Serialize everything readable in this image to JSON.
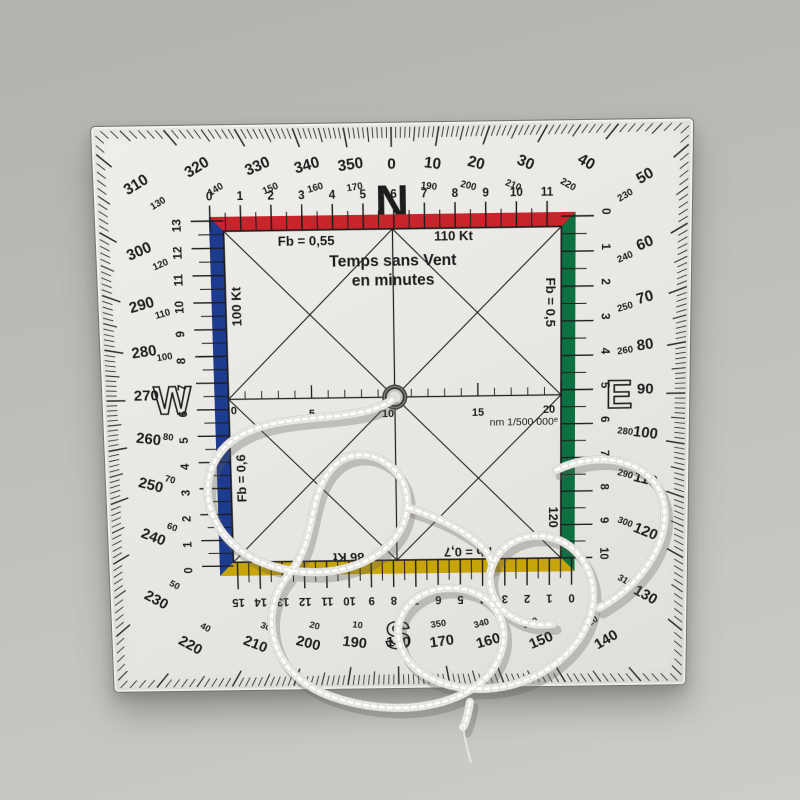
{
  "scene": {
    "description": "square transparent navigation plotter (protractor) lying on grey surface with white cord tangled on top"
  },
  "plotter": {
    "cardinals": {
      "north": "N",
      "east": "E",
      "south": "S",
      "west": "W"
    },
    "rose": {
      "ring_big_labels": {
        "top": [
          "320",
          "330",
          "340",
          "350",
          "0",
          "10",
          "20",
          "30",
          "40"
        ],
        "right": [
          "50",
          "60",
          "70",
          "80",
          "90",
          "100",
          "110",
          "120",
          "130"
        ],
        "bottom": [
          "140",
          "150",
          "160",
          "170",
          "180",
          "190",
          "200",
          "210",
          "220"
        ],
        "left": [
          "230",
          "240",
          "250",
          "260",
          "270",
          "280",
          "290",
          "300",
          "310"
        ]
      },
      "ring_small_labels": {
        "top": [
          "140",
          "150",
          "160",
          "170",
          "",
          "190",
          "200",
          "210",
          "220"
        ],
        "right": [
          "230",
          "240",
          "250",
          "260",
          "",
          "280",
          "290",
          "300",
          "310"
        ],
        "bottom": [
          "320",
          "330",
          "340",
          "350",
          "",
          "10",
          "20",
          "30",
          "40"
        ],
        "left": [
          "50",
          "60",
          "70",
          "80",
          "",
          "100",
          "110",
          "120",
          "130"
        ]
      }
    },
    "inner": {
      "title": [
        "Temps sans Vent",
        "en minutes"
      ],
      "labels": {
        "top_left": "Fb = 0,55",
        "top_right": "110 Kt",
        "left_top": "100 Kt",
        "left_bottom": "Fb = 0,6",
        "right_top": "Fb = 0,5",
        "right_bottom": "120",
        "bottom_left": "86 Kt",
        "bottom_right": "Fb = 0,7"
      },
      "scales": {
        "top": [
          "0",
          "1",
          "2",
          "3",
          "4",
          "5",
          "6",
          "7",
          "8",
          "9",
          "10",
          "11"
        ],
        "left": [
          "13",
          "12",
          "11",
          "10",
          "9",
          "8",
          "7",
          "6",
          "5",
          "4",
          "3",
          "2",
          "1",
          "0"
        ],
        "right": [
          "0",
          "1",
          "2",
          "3",
          "4",
          "5",
          "6",
          "7",
          "8",
          "9",
          "10"
        ],
        "bottom": [
          "0",
          "1",
          "2",
          "3",
          "4",
          "5",
          "6",
          "7",
          "8",
          "9",
          "10",
          "11",
          "12",
          "13",
          "14",
          "15"
        ]
      },
      "nm": {
        "labels": [
          "0",
          "5",
          "10",
          "15",
          "20"
        ],
        "caption": "nm 1/500 000",
        "caption_sup": "e"
      }
    },
    "colors": {
      "ink": "#1d1d1d",
      "bar_top_red": "#c8242c",
      "bar_left_blue": "#1e3c8f",
      "bar_right_green": "#0c7040",
      "bar_bottom_yellow": "#c7a40a",
      "plate": "#eae8e4",
      "background": "#bfbeba",
      "cord": "#f6f5f2"
    }
  }
}
